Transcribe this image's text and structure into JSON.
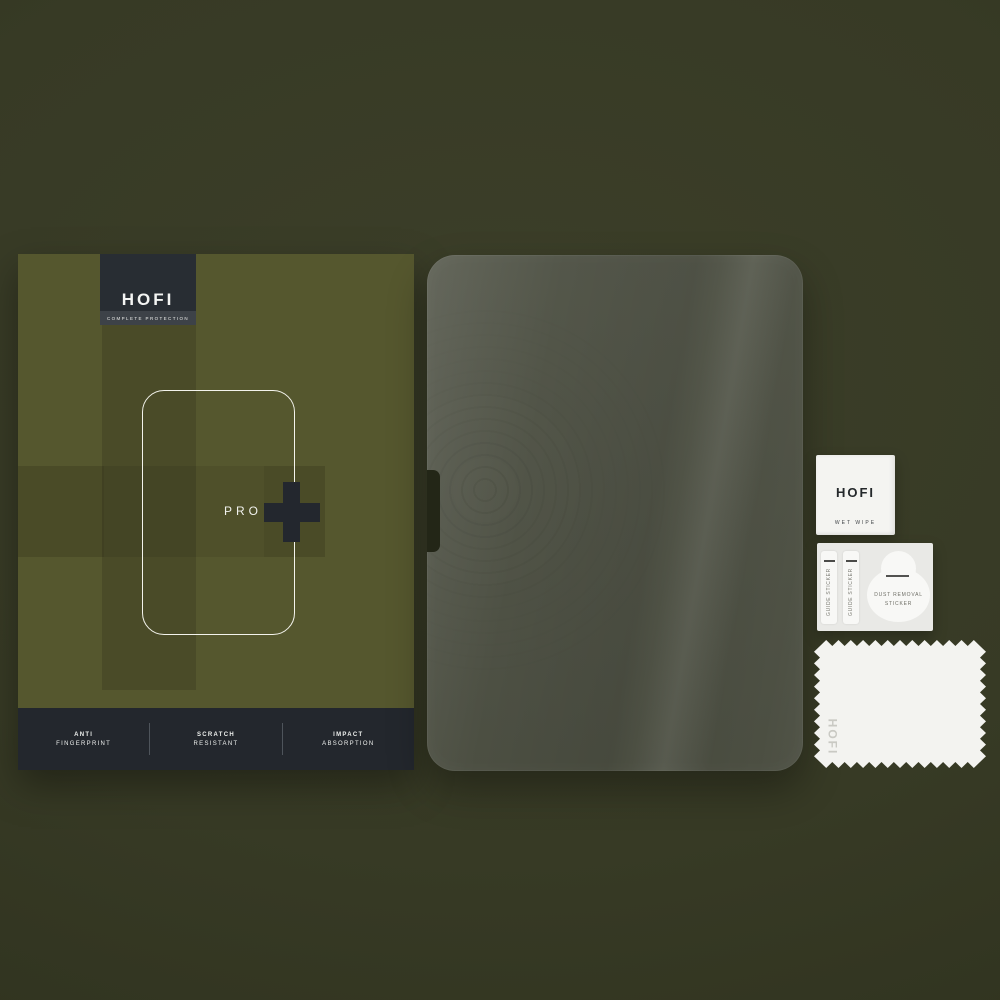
{
  "product": {
    "brand": "HOFI",
    "tagline": "COMPLETE PROTECTION",
    "model": "PRO",
    "model_plus": "+",
    "features": [
      {
        "line1": "ANTI",
        "line2": "FINGERPRINT"
      },
      {
        "line1": "SCRATCH",
        "line2": "RESISTANT"
      },
      {
        "line1": "IMPACT",
        "line2": "ABSORPTION"
      }
    ]
  },
  "accessories": {
    "wet_wipe": {
      "brand": "HOFI",
      "label": "WET WIPE"
    },
    "sticker_sheet": {
      "guide_stickers": [
        {
          "label": "GUIDE STICKER"
        },
        {
          "label": "GUIDE STICKER"
        }
      ],
      "dust_removal_label": "DUST REMOVAL STICKER"
    },
    "cloth": {
      "brand": "HOFI"
    }
  },
  "colors": {
    "background": "#373a25",
    "box_base": "#55572e",
    "logo_bg": "#282d33",
    "tagline_bg": "#3d4248",
    "features_bar_bg": "#23272d",
    "plus_accent": "#23272e",
    "glass": "#4e5144",
    "paper_white": "#f4f4f1"
  }
}
